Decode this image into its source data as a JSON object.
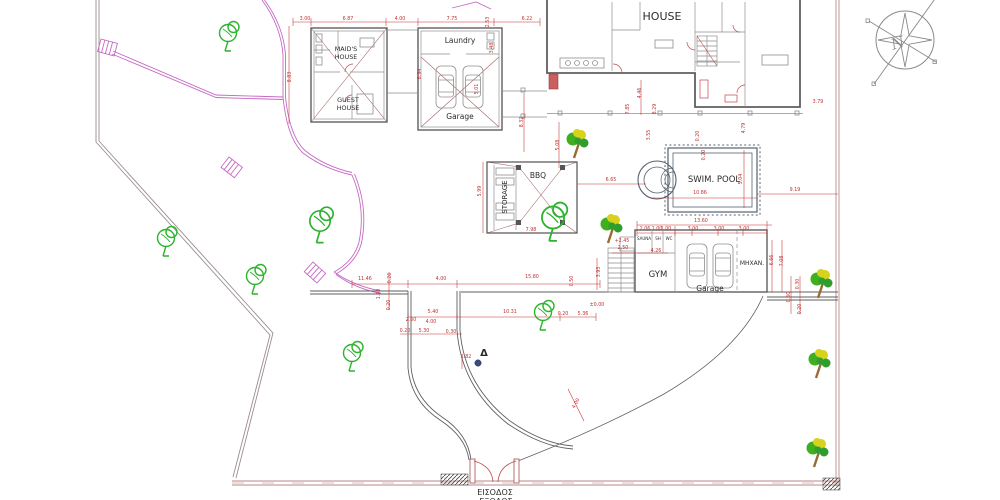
{
  "drawing": {
    "labels": {
      "house": "HOUSE",
      "maids_line1": "MAID'S",
      "maids_line2": "HOUSE",
      "guest_line1": "GUEST",
      "guest_line2": "HOUSE",
      "laundry": "Laundry",
      "garage_top": "Garage",
      "bbq": "BBQ",
      "storage": "STORAGE",
      "swim_pool": "SWIM. POOL",
      "gym": "GYM",
      "garage_bottom": "Garage",
      "mhxan": "MHXAN.",
      "sauna": "SAUNA",
      "sh": "SH",
      "wc": "WC",
      "entrance_line1": "ΕΙΣΟΔΟΣ",
      "entrance_line2": "ΕΞΟΔΟΣ",
      "north": "N",
      "delta_marker": "Δ"
    },
    "colors": {
      "dimension": "#c03030",
      "path_magenta": "#c46ac4",
      "boundary": "#b98a8a",
      "tree_outline": "#2db32d",
      "tree_green": "#3fae1f",
      "tree_green_dark": "#2f9e2f",
      "tree_yellow": "#d7d31c",
      "trunk": "#9a6a33",
      "marker_dot": "#3b4b80"
    },
    "dims": [
      {
        "t": "3.00",
        "x": 305,
        "y": 20,
        "r": 0
      },
      {
        "t": "6.87",
        "x": 348,
        "y": 20,
        "r": 0
      },
      {
        "t": "4.00",
        "x": 400,
        "y": 20,
        "r": 0
      },
      {
        "t": "7.75",
        "x": 452,
        "y": 20,
        "r": 0
      },
      {
        "t": "6.22",
        "x": 527,
        "y": 20,
        "r": 0
      },
      {
        "t": "2.53",
        "x": 489,
        "y": 22,
        "r": -90
      },
      {
        "t": "8.83",
        "x": 291,
        "y": 77,
        "r": -90
      },
      {
        "t": "8.94",
        "x": 421,
        "y": 74,
        "r": -90
      },
      {
        "t": "5.01",
        "x": 478,
        "y": 89,
        "r": -90
      },
      {
        "t": "3.48",
        "x": 493,
        "y": 48,
        "r": -90
      },
      {
        "t": "8.32",
        "x": 523,
        "y": 122,
        "r": -90
      },
      {
        "t": "5.08",
        "x": 559,
        "y": 145,
        "r": -90
      },
      {
        "t": "4.46",
        "x": 641,
        "y": 93,
        "r": -90
      },
      {
        "t": "7.85",
        "x": 629,
        "y": 109,
        "r": -90
      },
      {
        "t": "8.29",
        "x": 656,
        "y": 109,
        "r": -90
      },
      {
        "t": "4.79",
        "x": 745,
        "y": 128,
        "r": -90
      },
      {
        "t": "3.79",
        "x": 818,
        "y": 103,
        "r": 0
      },
      {
        "t": "3.55",
        "x": 650,
        "y": 135,
        "r": -90
      },
      {
        "t": "0.20",
        "x": 699,
        "y": 136,
        "r": -90
      },
      {
        "t": "0.20",
        "x": 705,
        "y": 155,
        "r": -90
      },
      {
        "t": "6.65",
        "x": 611,
        "y": 181,
        "r": 0
      },
      {
        "t": "5.99",
        "x": 481,
        "y": 191,
        "r": -90
      },
      {
        "t": "7.98",
        "x": 531,
        "y": 231,
        "r": 0
      },
      {
        "t": "10.86",
        "x": 700,
        "y": 194,
        "r": 0
      },
      {
        "t": "5.04",
        "x": 742,
        "y": 179,
        "r": -90
      },
      {
        "t": "9.19",
        "x": 795,
        "y": 191,
        "r": 0
      },
      {
        "t": "13.60",
        "x": 701,
        "y": 222,
        "r": 0
      },
      {
        "t": "2.06",
        "x": 645,
        "y": 230,
        "r": 0
      },
      {
        "t": "1.00",
        "x": 657,
        "y": 230,
        "r": 0
      },
      {
        "t": "1.00",
        "x": 666,
        "y": 230,
        "r": 0
      },
      {
        "t": "3.00",
        "x": 693,
        "y": 230,
        "r": 0
      },
      {
        "t": "3.00",
        "x": 719,
        "y": 230,
        "r": 0
      },
      {
        "t": "3.00",
        "x": 744,
        "y": 230,
        "r": 0
      },
      {
        "t": "+2.45",
        "x": 622,
        "y": 242,
        "r": 0
      },
      {
        "t": "2.50",
        "x": 623,
        "y": 249,
        "r": 0
      },
      {
        "t": "4.26",
        "x": 656,
        "y": 252,
        "r": 0
      },
      {
        "t": "3.93",
        "x": 600,
        "y": 272,
        "r": -90
      },
      {
        "t": "6.66",
        "x": 773,
        "y": 260,
        "r": -90
      },
      {
        "t": "7.08",
        "x": 783,
        "y": 261,
        "r": -90
      },
      {
        "t": "0.30",
        "x": 799,
        "y": 284,
        "r": -90
      },
      {
        "t": "0.60",
        "x": 790,
        "y": 297,
        "r": -90
      },
      {
        "t": "0.20",
        "x": 801,
        "y": 309,
        "r": -90
      },
      {
        "t": "11.46",
        "x": 365,
        "y": 280,
        "r": 0
      },
      {
        "t": "0.26",
        "x": 391,
        "y": 278,
        "r": -90
      },
      {
        "t": "4.00",
        "x": 441,
        "y": 280,
        "r": 0
      },
      {
        "t": "15.80",
        "x": 532,
        "y": 278,
        "r": 0
      },
      {
        "t": "0.50",
        "x": 573,
        "y": 281,
        "r": -90
      },
      {
        "t": "1.60",
        "x": 380,
        "y": 294,
        "r": -90
      },
      {
        "t": "0.20",
        "x": 390,
        "y": 305,
        "r": -90
      },
      {
        "t": "5.40",
        "x": 433,
        "y": 313,
        "r": 0
      },
      {
        "t": "10.31",
        "x": 510,
        "y": 313,
        "r": 0
      },
      {
        "t": "0.20",
        "x": 563,
        "y": 315,
        "r": 0
      },
      {
        "t": "5.36",
        "x": 583,
        "y": 315,
        "r": 0
      },
      {
        "t": "±0.00",
        "x": 597,
        "y": 306,
        "r": 0
      },
      {
        "t": "2.60",
        "x": 411,
        "y": 321,
        "r": 0
      },
      {
        "t": "4.00",
        "x": 431,
        "y": 323,
        "r": 0
      },
      {
        "t": "0.20",
        "x": 405,
        "y": 332,
        "r": 0
      },
      {
        "t": "5.30",
        "x": 424,
        "y": 332,
        "r": 0
      },
      {
        "t": "0.30",
        "x": 451,
        "y": 333,
        "r": 0
      },
      {
        "t": "1.82",
        "x": 466,
        "y": 358,
        "r": 0
      },
      {
        "t": "4.00",
        "x": 577,
        "y": 404,
        "r": -62
      }
    ],
    "trees": [
      {
        "type": "outline",
        "x": 228,
        "y": 38,
        "s": 1.0
      },
      {
        "type": "outline",
        "x": 166,
        "y": 243,
        "s": 1.0
      },
      {
        "type": "outline",
        "x": 255,
        "y": 281,
        "s": 1.0
      },
      {
        "type": "outline",
        "x": 320,
        "y": 227,
        "s": 1.2
      },
      {
        "type": "outline",
        "x": 352,
        "y": 358,
        "s": 1.0
      },
      {
        "type": "outline",
        "x": 543,
        "y": 317,
        "s": 1.0
      },
      {
        "type": "outline",
        "x": 553,
        "y": 224,
        "s": 1.3
      },
      {
        "type": "clump",
        "x": 578,
        "y": 146,
        "s": 1.0
      },
      {
        "type": "clump",
        "x": 612,
        "y": 231,
        "s": 1.0
      },
      {
        "type": "clump",
        "x": 822,
        "y": 286,
        "s": 1.0
      },
      {
        "type": "clump",
        "x": 820,
        "y": 366,
        "s": 1.0
      },
      {
        "type": "clump",
        "x": 818,
        "y": 455,
        "s": 1.0
      }
    ],
    "survey": {
      "value": "1.82"
    }
  }
}
